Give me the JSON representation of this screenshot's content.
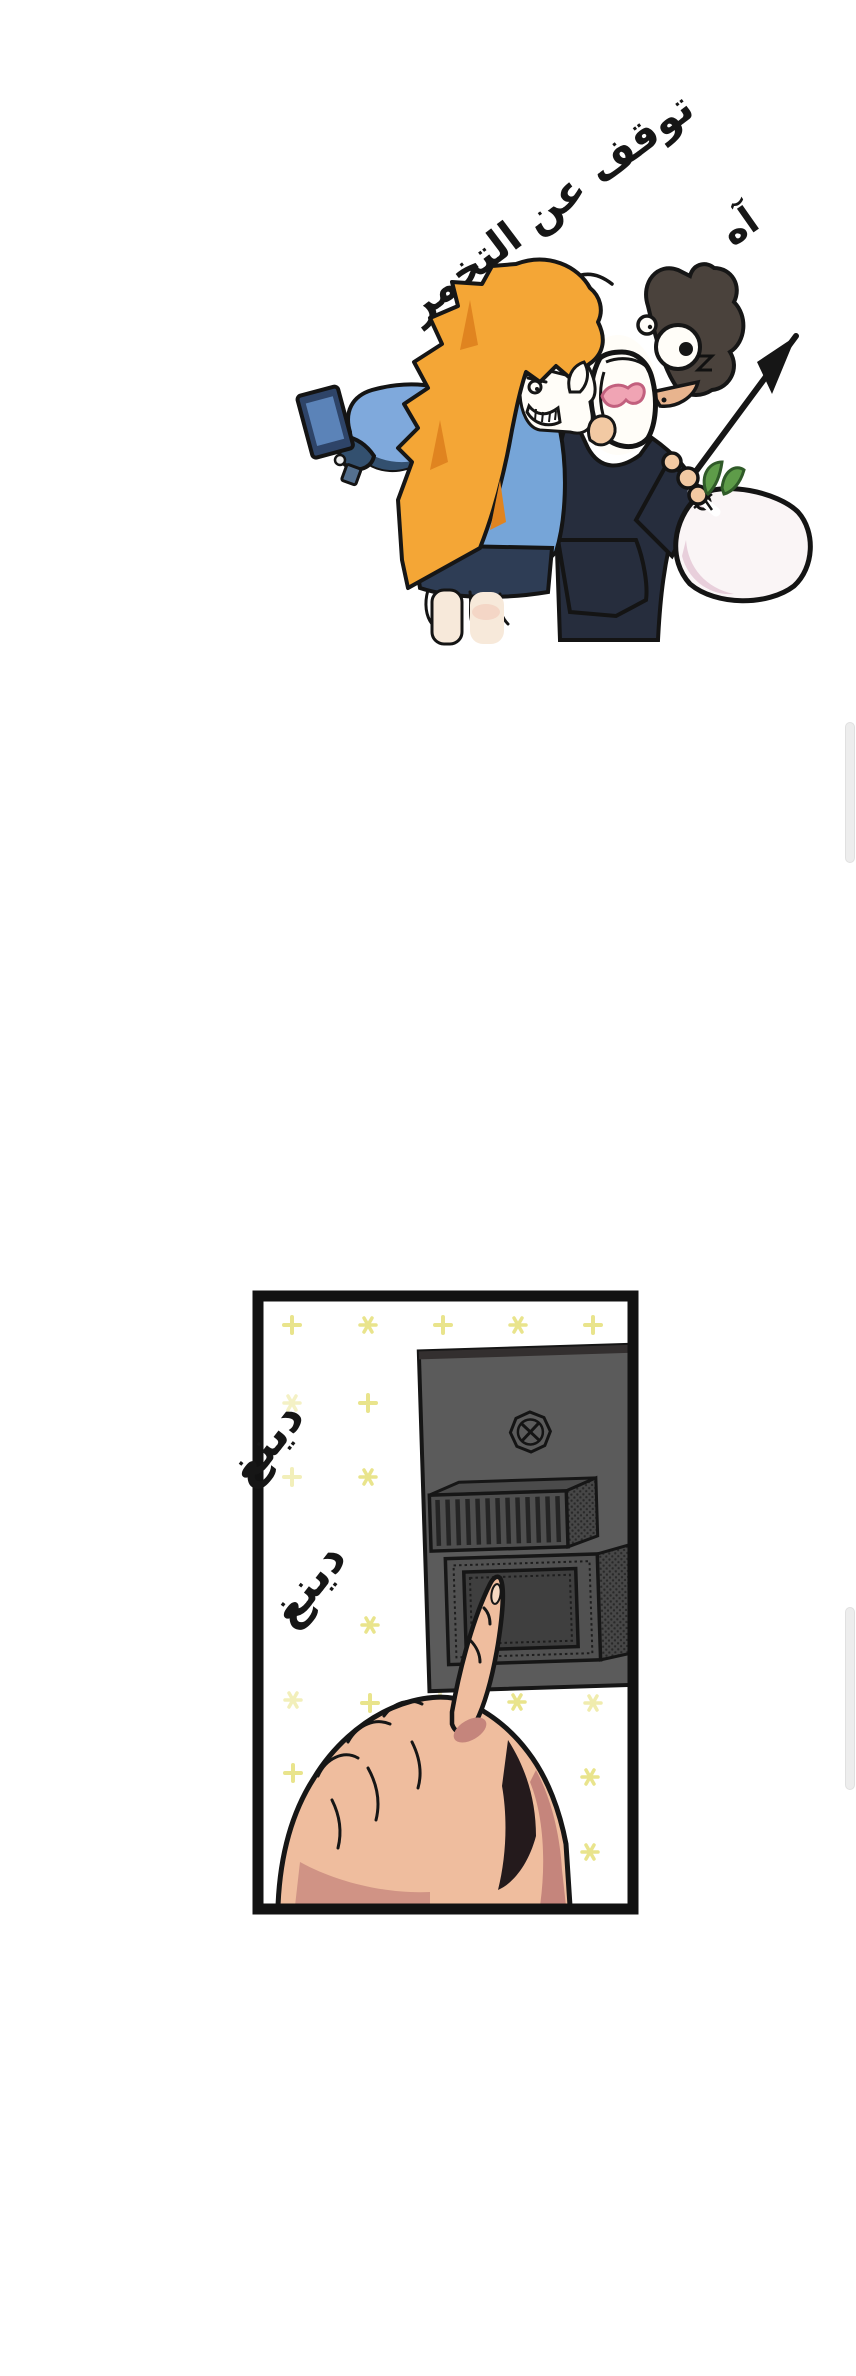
{
  "page": {
    "background": "#ffffff",
    "width": 856,
    "height": 2376
  },
  "colors": {
    "ink": "#161616",
    "hair_orange": "#F4A636",
    "hair_orange_shade": "#E08420",
    "jacket_blue": "#76A5D8",
    "jacket_blue_light": "#8FB9E4",
    "jacket_navy": "#33506F",
    "skirt_navy": "#2E3D55",
    "dark_outfit": "#262D3D",
    "man_hair": "#4A423C",
    "face_white": "#FFFDF8",
    "skin": "#F2C9A3",
    "hand_skin": "#EFBD9E",
    "hand_shadow": "#C5857C",
    "tongue_pink": "#F0A4B4",
    "sack_white": "#FAF5F6",
    "sack_shade": "#E8CFDB",
    "sprout_green": "#5E9C49",
    "phone_navy": "#2E4468",
    "phone_screen": "#5B83B8",
    "legs_cream": "#F7E9DA",
    "intercom_gray": "#5B5B5B",
    "intercom_dark": "#3F3F3F",
    "sparkle_yellow": "#E9E48C",
    "panel_border": "#121212",
    "scrollbar_thumb": "#EDEDED"
  },
  "top_illustration": {
    "sfx_stop": "توقف عن التخمر",
    "sfx_ah": "آه"
  },
  "panel": {
    "sfx_ding_first": "دينغ",
    "sfx_ding_second": "دينغ"
  }
}
